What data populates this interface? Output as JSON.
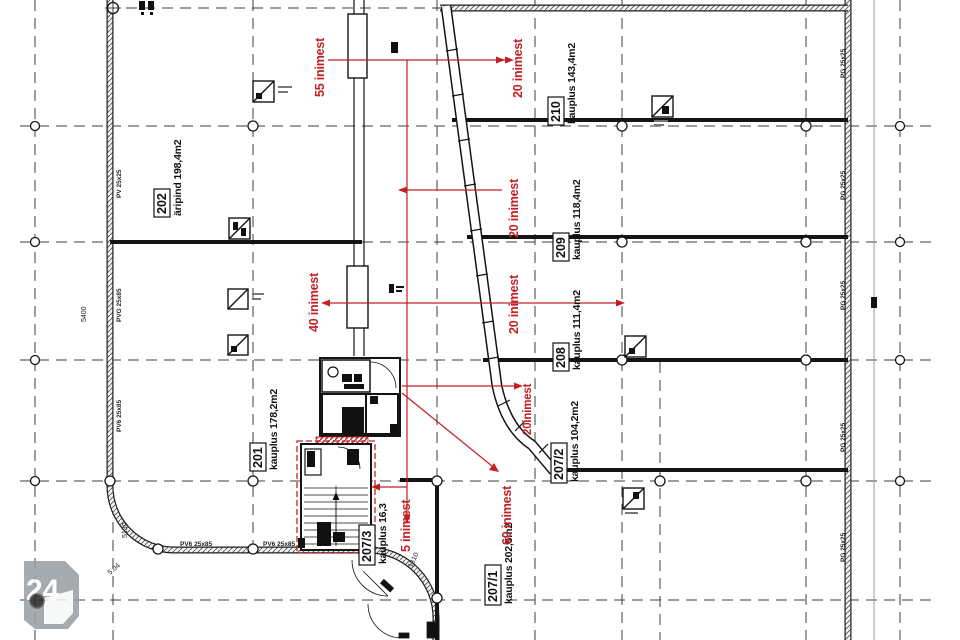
{
  "drawing": {
    "kind": "architectural floor plan",
    "rooms": [
      {
        "number": "202",
        "area": "äripind 198,4m2"
      },
      {
        "number": "201",
        "area": "kauplus 178,2m2"
      },
      {
        "number": "210",
        "area": "kauplus 143,4m2"
      },
      {
        "number": "209",
        "area": "kauplus 118,4m2"
      },
      {
        "number": "208",
        "area": "kauplus 111,4m2"
      },
      {
        "number": "207/2",
        "area": "kauplus 104,2m2"
      },
      {
        "number": "207/1",
        "area": "kauplus 202,5m2"
      },
      {
        "number": "207/3",
        "area": "kauplus 16,3"
      }
    ],
    "occupancy_notes": [
      {
        "text": "55 inimest"
      },
      {
        "text": "20 inimest"
      },
      {
        "text": "20 inimest"
      },
      {
        "text": "40 inimest"
      },
      {
        "text": "20 inimest"
      },
      {
        "text": "20inimest"
      },
      {
        "text": "60 inimest"
      },
      {
        "text": "5 inimest"
      }
    ],
    "wall_marks": {
      "left": [
        "PV 25x25",
        "PVG 25x85",
        "PV6 25x85"
      ],
      "right": [
        "PG 25x25",
        "PG 25x25",
        "PG 25x25",
        "PG 25x25",
        "PG 25x25"
      ],
      "bottom": [
        "PV6 25x85",
        "PV6 25x85"
      ]
    },
    "dimensions": [
      "5400",
      "5130",
      "1310",
      "5.04"
    ],
    "colors": {
      "annotation_red": "#c22026",
      "wall_line": "#141414",
      "grid_line": "#3c3c3c",
      "watermark_gray": "#9aa0a6"
    }
  },
  "watermark": {
    "label": "24"
  }
}
